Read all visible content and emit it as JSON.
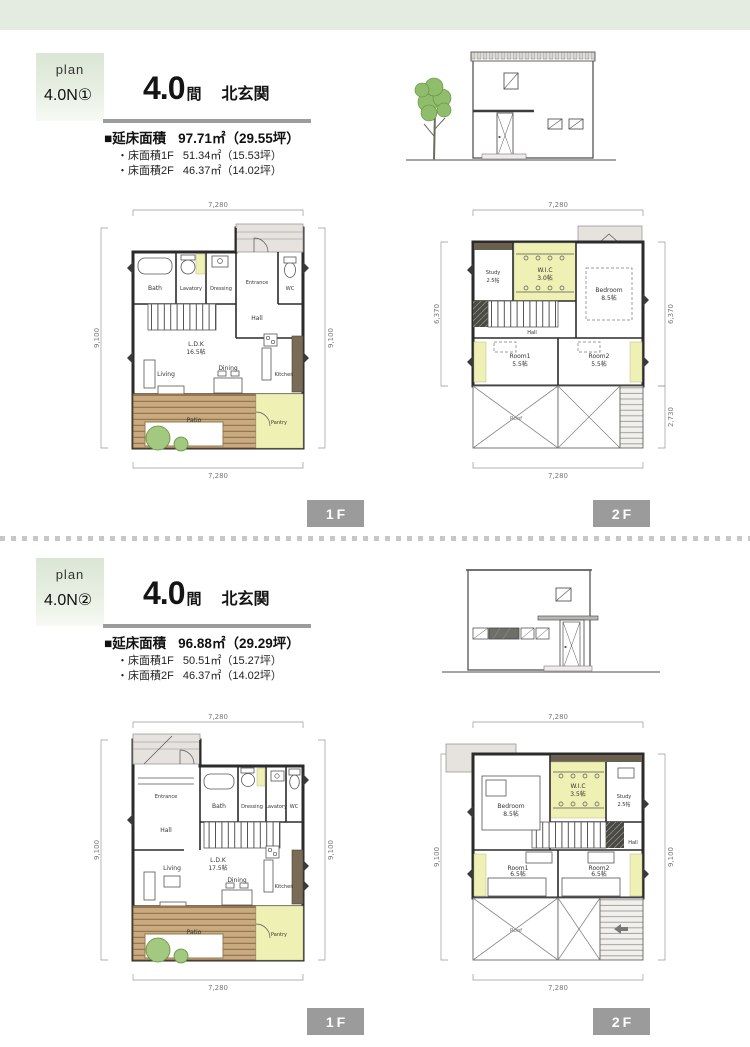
{
  "page": {
    "tags": {
      "f1": "1F",
      "f2": "2F"
    }
  },
  "sections": [
    {
      "badge_plan": "plan",
      "badge_code": "4.0N①",
      "title_num": "4.0",
      "title_unit": "間",
      "title_dir": "北玄関",
      "area_total_label": "■延床面積",
      "area_total_value": "97.71㎡（29.55坪）",
      "area_f1_label": "・床面積1F",
      "area_f1_value": "51.34㎡（15.53坪）",
      "area_f2_label": "・床面積2F",
      "area_f2_value": "46.37㎡（14.02坪）",
      "f1": {
        "dim_top": "7,280",
        "dim_bottom": "7,280",
        "dim_left": "9,100",
        "dim_right": "9,100",
        "bath": "Bath",
        "lavatory": "Lavatory",
        "dressing": "Dressing",
        "entrance": "Entrance",
        "wc": "WC",
        "hall": "Hall",
        "ldk": "L.D.K",
        "ldk_size": "16.5帖",
        "living": "Living",
        "dining": "Dining",
        "kitchen": "Kitchen",
        "patio": "Patio",
        "pantry": "Pantry"
      },
      "f2": {
        "dim_top": "7,280",
        "dim_bottom": "7,280",
        "dim_left": "6,370",
        "dim_right_upper": "6,370",
        "dim_right_lower": "2,730",
        "study": "Study",
        "study_size": "2.5帖",
        "wic": "W.I.C",
        "wic_size": "3.0帖",
        "bedroom": "Bedroom",
        "bedroom_size": "8.5帖",
        "hall": "Hall",
        "room1": "Room1",
        "room1_size": "5.5帖",
        "room2": "Room2",
        "room2_size": "5.5帖",
        "roof": "Roof"
      }
    },
    {
      "badge_plan": "plan",
      "badge_code": "4.0N②",
      "title_num": "4.0",
      "title_unit": "間",
      "title_dir": "北玄関",
      "area_total_label": "■延床面積",
      "area_total_value": "96.88㎡（29.29坪）",
      "area_f1_label": "・床面積1F",
      "area_f1_value": "50.51㎡（15.27坪）",
      "area_f2_label": "・床面積2F",
      "area_f2_value": "46.37㎡（14.02坪）",
      "f1": {
        "dim_top": "7,280",
        "dim_bottom": "7,280",
        "dim_left": "9,100",
        "dim_right": "9,100",
        "entrance": "Entrance",
        "hall": "Hall",
        "bath": "Bath",
        "dressing": "Dressing",
        "lavatory": "Lavatory",
        "wc": "WC",
        "ldk": "L.D.K",
        "ldk_size": "17.5帖",
        "living": "Living",
        "dining": "Dining",
        "kitchen": "Kitchen",
        "patio": "Patio",
        "pantry": "Pantry"
      },
      "f2": {
        "dim_top": "7,280",
        "dim_bottom": "7,280",
        "dim_left": "9,100",
        "dim_right": "9,100",
        "bedroom": "Bedroom",
        "bedroom_size": "8.5帖",
        "wic": "W.I.C",
        "wic_size": "3.5帖",
        "study": "Study",
        "study_size": "2.5帖",
        "hall": "Hall",
        "room1": "Room1",
        "room1_size": "6.5帖",
        "room2": "Room2",
        "room2_size": "6.5帖",
        "roof": "Roof"
      }
    }
  ]
}
